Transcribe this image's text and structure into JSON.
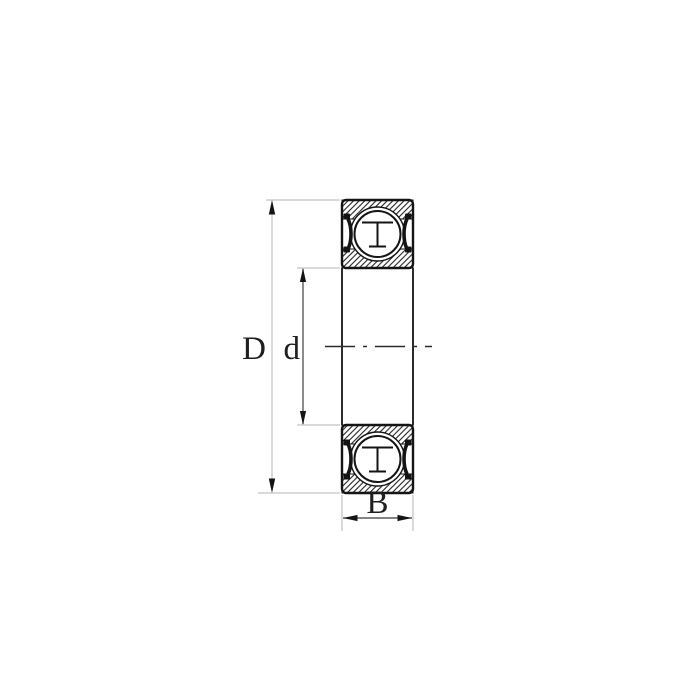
{
  "diagram": {
    "kind": "ball-bearing-cross-section",
    "labels": {
      "outer_diameter": "D",
      "bore_diameter": "d",
      "width": "B"
    },
    "colors": {
      "background": "#ffffff",
      "line": "#141414",
      "dimension_line": "#b5b5b5",
      "bore_dimension_line": "#4d4d4d",
      "width_dimension_line": "#3a3a3a",
      "label": "#1f1f1f"
    }
  }
}
